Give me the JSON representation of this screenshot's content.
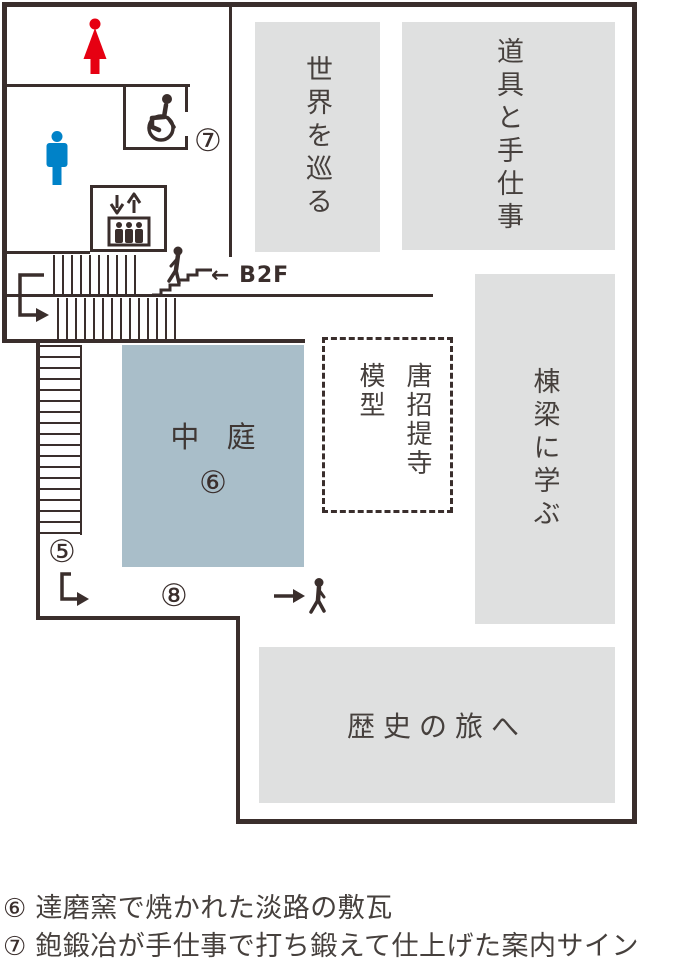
{
  "colors": {
    "wall": "#3a2e2c",
    "room_fill": "#dfe0e0",
    "courtyard_fill": "#a9bec9",
    "women_icon": "#e60012",
    "men_icon": "#0082c8"
  },
  "floorplan": {
    "rooms": {
      "world": {
        "label": "世界を巡る"
      },
      "tools": {
        "label": "道具と手仕事"
      },
      "master": {
        "label": "棟梁に学ぶ"
      },
      "history": {
        "label": "歴史の旅へ"
      }
    },
    "courtyard": {
      "label": "中 庭",
      "number": "⑥"
    },
    "model": {
      "name": "唐招提寺",
      "type": "模型"
    },
    "markers": {
      "five": "⑤",
      "seven": "⑦",
      "eight": "⑧"
    },
    "b2f": {
      "label": "← B2F"
    }
  },
  "icons": {
    "women-restroom-icon": "woman pictogram",
    "men-restroom-icon": "man pictogram",
    "wheelchair-icon": "wheelchair accessible pictogram",
    "elevator-icon": "elevator pictogram",
    "stairs-person-icon": "person on stairs",
    "walking-person-icon": "walking person",
    "u-turn-arrow-icon": "down-then-right arrow",
    "l-arrow-icon": "down-then-right arrow",
    "right-arrow-icon": "→"
  },
  "legend": {
    "items": [
      {
        "number": "⑥",
        "text": "達磨窯で焼かれた淡路の敷瓦"
      },
      {
        "number": "⑦",
        "text": "鉋鍛冶が手仕事で打ち鍛えて仕上げた案内サイン"
      }
    ]
  }
}
